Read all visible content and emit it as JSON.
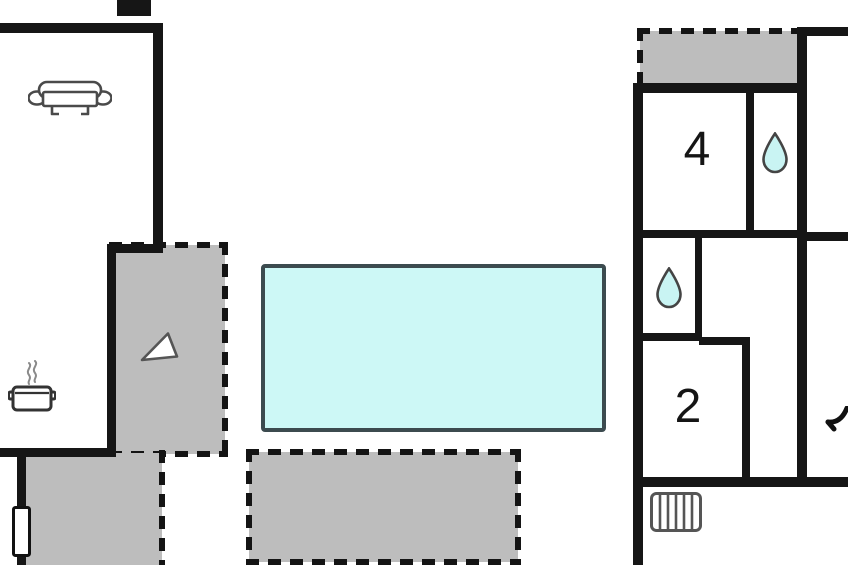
{
  "floor_plan": {
    "type": "floor-plan",
    "canvas": {
      "width": 848,
      "height": 565,
      "background": "#ffffff"
    },
    "colors": {
      "wall": "#161616",
      "dash": "#141414",
      "terrace_fill": "#bdbdbd",
      "pool_fill": "#cdf8f6",
      "pool_border": "#3c4b4f",
      "water_drop_fill": "#c9f4f3",
      "icon_stroke": "#4a4a4a",
      "label_color": "#151515"
    },
    "rooms": [
      {
        "name": "bedroom-4",
        "label": "4",
        "label_x": 697,
        "label_y": 152
      },
      {
        "name": "bedroom-2",
        "label": "2",
        "label_x": 688,
        "label_y": 409
      }
    ],
    "pool": {
      "name": "swimming-pool",
      "x": 263,
      "y": 266,
      "w": 341,
      "h": 164
    },
    "terraces": [
      {
        "name": "stairs-terrace",
        "x": 112,
        "y": 245,
        "w": 113,
        "h": 209,
        "dashed": [
          "top",
          "right",
          "bottom"
        ]
      },
      {
        "name": "lower-left-terrace",
        "x": 21,
        "y": 453,
        "w": 141,
        "h": 112,
        "dashed": [
          "right"
        ]
      },
      {
        "name": "bottom-terrace",
        "x": 249,
        "y": 452,
        "w": 269,
        "h": 110,
        "dashed": [
          "top",
          "right",
          "bottom",
          "left"
        ]
      },
      {
        "name": "top-right-terrace",
        "x": 640,
        "y": 31,
        "w": 158,
        "h": 52,
        "dashed": [
          "top",
          "left"
        ]
      }
    ],
    "walls": [
      {
        "name": "living-room-top-wall",
        "x": 0,
        "y": 23,
        "w": 163,
        "h": 10
      },
      {
        "name": "living-room-right-wall",
        "x": 153,
        "y": 23,
        "w": 10,
        "h": 230
      },
      {
        "name": "living-room-bottom-stub-wall",
        "x": 107,
        "y": 244,
        "w": 56,
        "h": 9
      },
      {
        "name": "living-room-left-lower-wall",
        "x": 107,
        "y": 244,
        "w": 9,
        "h": 213
      },
      {
        "name": "living-room-bottom-wall",
        "x": 0,
        "y": 448,
        "w": 116,
        "h": 9
      },
      {
        "name": "chimney",
        "x": 117,
        "y": 0,
        "w": 34,
        "h": 16
      },
      {
        "name": "terrace-left-wall",
        "x": 17,
        "y": 453,
        "w": 9,
        "h": 112
      },
      {
        "name": "right-house-top-right-wall",
        "x": 797,
        "y": 27,
        "w": 51,
        "h": 9
      },
      {
        "name": "right-house-right-wall",
        "x": 797,
        "y": 27,
        "w": 10,
        "h": 460
      },
      {
        "name": "right-house-top-wall",
        "x": 633,
        "y": 83,
        "w": 174,
        "h": 10
      },
      {
        "name": "right-house-left-wall",
        "x": 633,
        "y": 83,
        "w": 10,
        "h": 482
      },
      {
        "name": "bedroom4-bath-divider-wall",
        "x": 746,
        "y": 93,
        "w": 8,
        "h": 140
      },
      {
        "name": "right-house-middle-wall",
        "x": 637,
        "y": 230,
        "w": 166,
        "h": 8
      },
      {
        "name": "bath2-right-wall",
        "x": 695,
        "y": 236,
        "w": 7,
        "h": 102
      },
      {
        "name": "bath2-bottom-wall",
        "x": 640,
        "y": 333,
        "w": 62,
        "h": 8
      },
      {
        "name": "bedroom2-top-right-wall",
        "x": 699,
        "y": 337,
        "w": 51,
        "h": 8
      },
      {
        "name": "bedroom2-right-wall",
        "x": 742,
        "y": 340,
        "w": 8,
        "h": 143
      },
      {
        "name": "right-house-bottom-wall",
        "x": 633,
        "y": 477,
        "w": 215,
        "h": 10
      },
      {
        "name": "right-house-middle-right-wall",
        "x": 797,
        "y": 232,
        "w": 51,
        "h": 9
      }
    ],
    "icons": [
      {
        "name": "sofa-icon",
        "symbol": "sym-sofa",
        "x": 28,
        "y": 80
      },
      {
        "name": "cooking-pot-icon",
        "symbol": "sym-pot",
        "x": 8,
        "y": 360
      },
      {
        "name": "stairs-arrow-icon",
        "symbol": "sym-triangle",
        "x": 140,
        "y": 331
      },
      {
        "name": "water-drop-icon",
        "symbol": "sym-drop",
        "x": 762,
        "y": 132
      },
      {
        "name": "water-drop-icon",
        "symbol": "sym-drop",
        "x": 656,
        "y": 267
      },
      {
        "name": "radiator-icon",
        "symbol": "sym-radiator",
        "x": 650,
        "y": 492
      },
      {
        "name": "window-icon",
        "symbol": "sym-window",
        "x": 12,
        "y": 506
      },
      {
        "name": "curve-mark-icon",
        "symbol": "sym-curve",
        "x": 824,
        "y": 406
      }
    ],
    "dash_style": {
      "width": 6,
      "dash": 13,
      "gap": 9
    }
  }
}
